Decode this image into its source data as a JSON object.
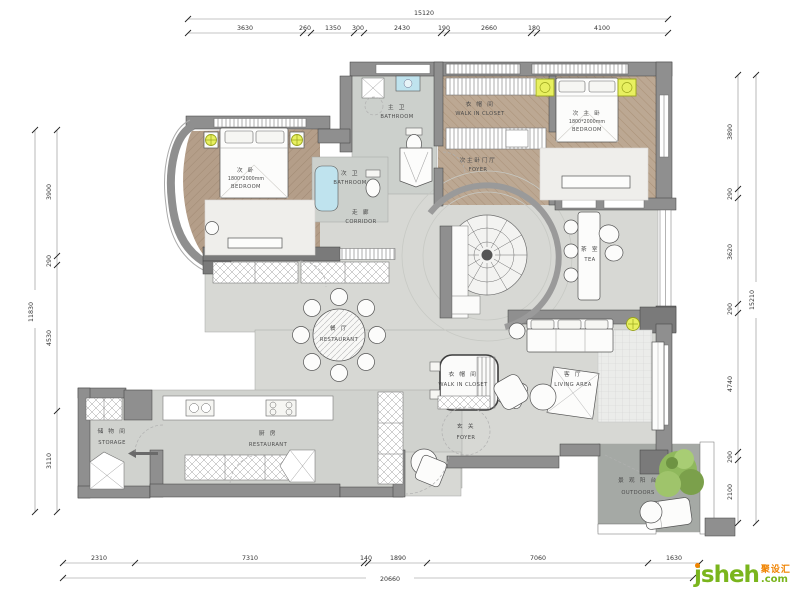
{
  "rooms": {
    "bedroom_left": {
      "zh": "次 卧",
      "size": "1800*2000mm",
      "en": "BEDROOM"
    },
    "bathroom_top": {
      "zh": "主 卫",
      "en": "BATHROOM"
    },
    "closet_top": {
      "zh": "衣 帽 间",
      "en": "WALK IN CLOSET"
    },
    "foyer_top": {
      "zh": "次主卧门厅",
      "en": "FOYER"
    },
    "bedroom_right": {
      "zh": "次 主 卧",
      "size": "1800*2000mm",
      "en": "BEDROOM"
    },
    "bathroom_small": {
      "zh": "次 卫",
      "en": "BATHROOM"
    },
    "corridor": {
      "zh": "走 廊",
      "en": "CORRIDOR"
    },
    "tea": {
      "zh": "茶 室",
      "en": "TEA"
    },
    "restaurant": {
      "zh": "餐 厅",
      "en": "RESTAURANT"
    },
    "closet_mid": {
      "zh": "衣 帽 间",
      "en": "WALK IN CLOSET"
    },
    "living": {
      "zh": "客 厅",
      "en": "LIVING AREA"
    },
    "storage": {
      "zh": "储 物 间",
      "en": "STORAGE"
    },
    "kitchen": {
      "zh": "厨 房",
      "en": "RESTAURANT"
    },
    "foyer_main": {
      "zh": "玄 关",
      "en": "FOYER"
    },
    "outdoors": {
      "zh": "景 观 阳 台",
      "en": "OUTDOORS"
    }
  },
  "dimensions": {
    "top": {
      "total": "15120",
      "segments": [
        "3630",
        "260",
        "1350",
        "300",
        "2430",
        "190",
        "2660",
        "180",
        "4100"
      ]
    },
    "bottom": {
      "total": "20660",
      "segments": [
        "2310",
        "7310",
        "140",
        "1890",
        "7060",
        "1630"
      ]
    },
    "left": {
      "total": "11830",
      "segments": [
        "3900",
        "290",
        "4530",
        "3110"
      ]
    },
    "right": {
      "total": "15210",
      "segments": [
        "3890",
        "290",
        "3620",
        "290",
        "4740",
        "290",
        "2100"
      ]
    }
  },
  "watermark": {
    "name": "jsheh",
    "zh": "聚设汇",
    "tld": ".com"
  },
  "colors": {
    "wall": "#8f8f8f",
    "wood": "#b49e89",
    "marble": "#d7d8d4",
    "highlight": "#e8f060",
    "fixture_blue": "#bfe3ee",
    "tree": "#8fb85c",
    "outdoor_floor": "#a5a9a5",
    "wm_green": "#7ab51d",
    "wm_orange": "#f08300"
  }
}
